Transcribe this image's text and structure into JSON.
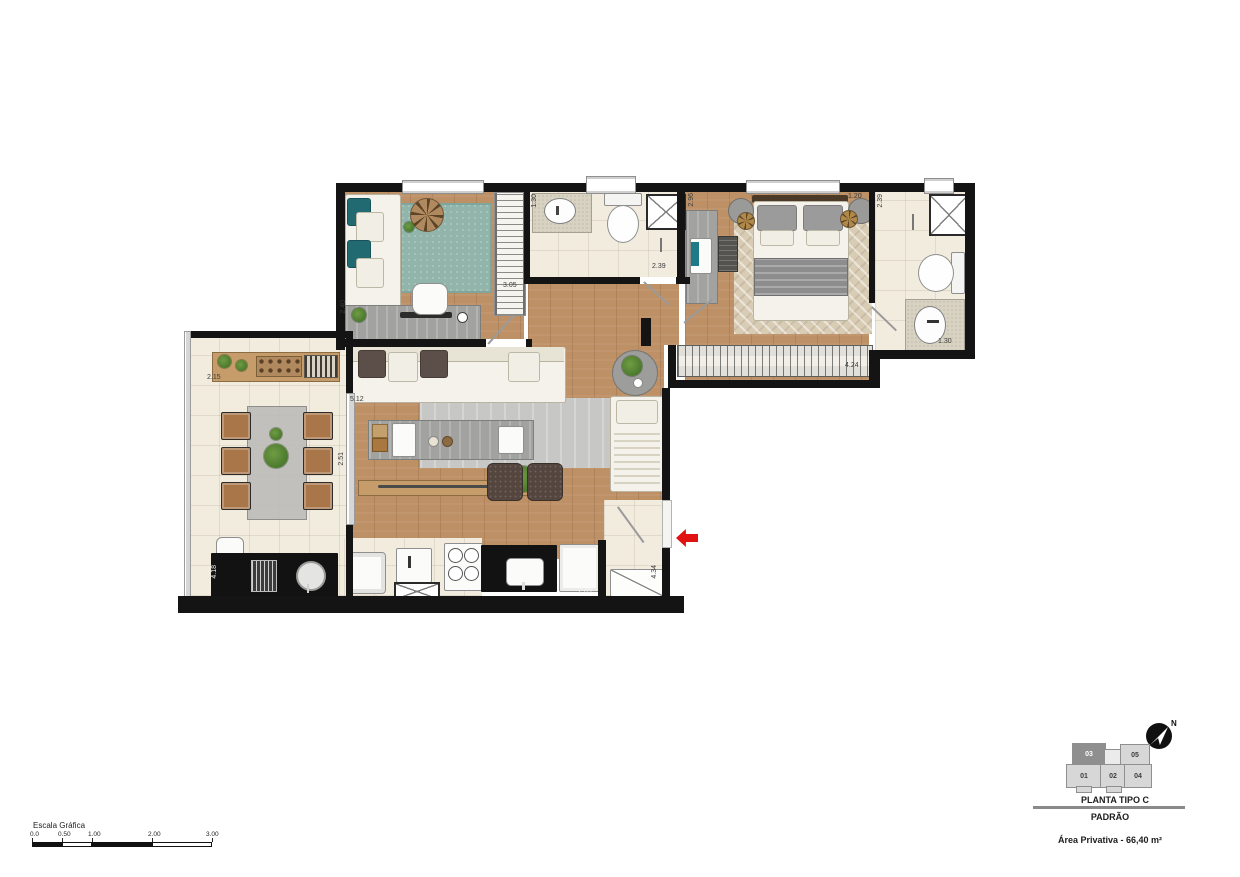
{
  "plan": {
    "dimensions": {
      "bedroom1_side": "2.40",
      "bedroom1_wardrobe": "3.05",
      "bath_sink": "1.30",
      "bath_width": "2.39",
      "master_desk_side": "2.96",
      "master_top": "1.20",
      "ensuite_depth": "2.39",
      "ensuite_sink": "1.30",
      "closet_width": "4.24",
      "terrace_top": "2.15",
      "living_side": "5.12",
      "living_bench": "2.51",
      "terrace_counter": "4.18",
      "kitchen_counter": "2.65",
      "entry_side": "4.34"
    },
    "colors": {
      "wall": "#141414",
      "wood_floor": "#bd9066",
      "tile_floor": "#f2ecdf",
      "teal_rug": "#92b5ab",
      "entrance_arrow": "#e01212"
    }
  },
  "legend": {
    "north_label": "N",
    "key_plan": {
      "highlighted_unit": "03",
      "units": {
        "u01": "01",
        "u02": "02",
        "u03": "03",
        "u04": "04",
        "u05": "05"
      }
    },
    "title": "PLANTA TIPO C",
    "subtitle": "PADRÃO",
    "area_label": "Área Privativa -  66,40 m²"
  },
  "scale_bar": {
    "label": "Escala Gráfica",
    "ticks": [
      "0.0",
      "0.50",
      "1.00",
      "2.00",
      "3.00"
    ]
  }
}
